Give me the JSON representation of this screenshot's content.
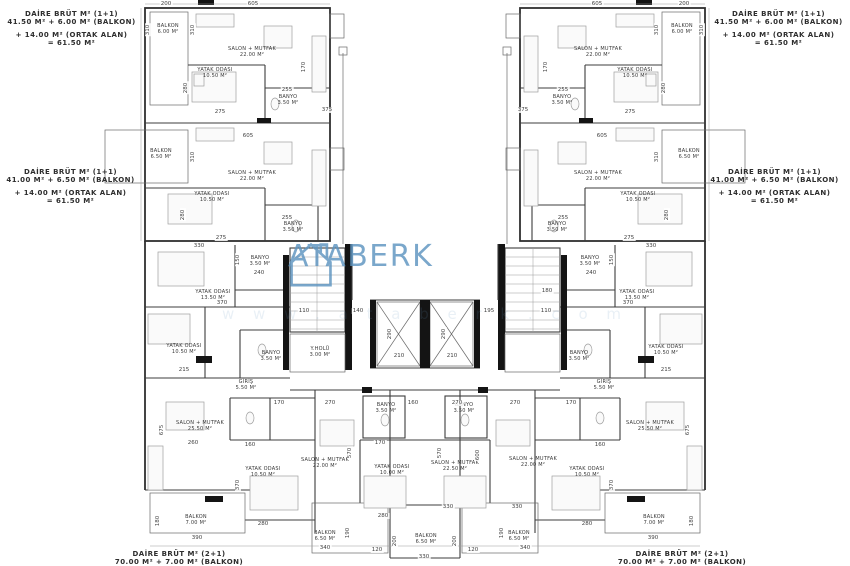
{
  "watermark": {
    "name": "ATABERK",
    "sub": "w w w . a t a b e r k . c o m",
    "color": "#5d94c0"
  },
  "annotations": {
    "top_left": [
      "DAİRE BRÜT M² (1+1)",
      "41.50 M² + 6.00 M² (BALKON)",
      "+ 14.00 M² (ORTAK ALAN)",
      "= 61.50 M²"
    ],
    "top_right": [
      "DAİRE BRÜT M² (1+1)",
      "41.50 M² + 6.00 M² (BALKON)",
      "+ 14.00 M² (ORTAK ALAN)",
      "= 61.50 M²"
    ],
    "mid_left": [
      "DAİRE BRÜT M² (1+1)",
      "41.00 M² + 6.50 M² (BALKON)",
      "+ 14.00 M² (ORTAK ALAN)",
      "= 61.50 M²"
    ],
    "mid_right": [
      "DAİRE BRÜT M² (1+1)",
      "41.00 M² + 6.50 M² (BALKON)",
      "+ 14.00 M² (ORTAK ALAN)",
      "= 61.50 M²"
    ],
    "bottom_left": [
      "DAİRE BRÜT M² (2+1)",
      "70.00 M² + 7.00 M² (BALKON)"
    ],
    "bottom_right": [
      "DAİRE BRÜT M² (2+1)",
      "70.00 M² + 7.00 M² (BALKON)"
    ]
  },
  "room_labels": [
    {
      "name": "BALKON",
      "area": "6.00 M²",
      "x": 168,
      "y": 30
    },
    {
      "name": "SALON + MUTFAK",
      "area": "22.00 M²",
      "x": 252,
      "y": 53
    },
    {
      "name": "YATAK ODASI",
      "area": "10.50 M²",
      "x": 215,
      "y": 74
    },
    {
      "name": "BANYO",
      "area": "3.50 M²",
      "x": 288,
      "y": 101
    },
    {
      "name": "BALKON",
      "area": "6.00 M²",
      "x": 682,
      "y": 30
    },
    {
      "name": "SALON + MUTFAK",
      "area": "22.00 M²",
      "x": 598,
      "y": 53
    },
    {
      "name": "YATAK ODASI",
      "area": "10.50 M²",
      "x": 635,
      "y": 74
    },
    {
      "name": "BANYO",
      "area": "3.50 M²",
      "x": 562,
      "y": 101
    },
    {
      "name": "BALKON",
      "area": "6.50 M²",
      "x": 161,
      "y": 155
    },
    {
      "name": "SALON + MUTFAK",
      "area": "22.00 M²",
      "x": 252,
      "y": 177
    },
    {
      "name": "YATAK ODASI",
      "area": "10.50 M²",
      "x": 212,
      "y": 198
    },
    {
      "name": "BANYO",
      "area": "3.50 M²",
      "x": 293,
      "y": 228
    },
    {
      "name": "BALKON",
      "area": "6.50 M²",
      "x": 689,
      "y": 155
    },
    {
      "name": "SALON + MUTFAK",
      "area": "22.00 M²",
      "x": 598,
      "y": 177
    },
    {
      "name": "YATAK ODASI",
      "area": "10.50 M²",
      "x": 638,
      "y": 198
    },
    {
      "name": "BANYO",
      "area": "3.50 M²",
      "x": 557,
      "y": 228
    },
    {
      "name": "YATAK ODASI",
      "area": "13.50 M²",
      "x": 213,
      "y": 296
    },
    {
      "name": "BANYO",
      "area": "3.50 M²",
      "x": 260,
      "y": 262
    },
    {
      "name": "YATAK ODASI",
      "area": "10.50 M²",
      "x": 184,
      "y": 350
    },
    {
      "name": "BANYO",
      "area": "3.50 M²",
      "x": 271,
      "y": 357
    },
    {
      "name": "Y.HOLÜ",
      "area": "3.00 M²",
      "x": 320,
      "y": 353
    },
    {
      "name": "GİRİŞ",
      "area": "5.50 M²",
      "x": 246,
      "y": 386
    },
    {
      "name": "YATAK ODASI",
      "area": "13.50 M²",
      "x": 637,
      "y": 296
    },
    {
      "name": "BANYO",
      "area": "3.50 M²",
      "x": 590,
      "y": 262
    },
    {
      "name": "YATAK ODASI",
      "area": "10.50 M²",
      "x": 666,
      "y": 351
    },
    {
      "name": "BANYO",
      "area": "3.50 M²",
      "x": 579,
      "y": 357
    },
    {
      "name": "GİRİŞ",
      "area": "5.50 M²",
      "x": 604,
      "y": 386
    },
    {
      "name": "SALON + MUTFAK",
      "area": "25.50 M²",
      "x": 200,
      "y": 427
    },
    {
      "name": "YATAK ODASI",
      "area": "10.50 M²",
      "x": 263,
      "y": 473
    },
    {
      "name": "BALKON",
      "area": "7.00 M²",
      "x": 196,
      "y": 521
    },
    {
      "name": "SALON + MUTFAK",
      "area": "25.50 M²",
      "x": 650,
      "y": 427
    },
    {
      "name": "YATAK ODASI",
      "area": "10.50 M²",
      "x": 587,
      "y": 473
    },
    {
      "name": "BALKON",
      "area": "7.00 M²",
      "x": 654,
      "y": 521
    },
    {
      "name": "SALON + MUTFAK",
      "area": "22.00 M²",
      "x": 325,
      "y": 464
    },
    {
      "name": "BANYO",
      "area": "3.50 M²",
      "x": 386,
      "y": 409
    },
    {
      "name": "YATAK ODASI",
      "area": "10.00 M²",
      "x": 392,
      "y": 471
    },
    {
      "name": "SALON + MUTFAK",
      "area": "22.50 M²",
      "x": 455,
      "y": 467
    },
    {
      "name": "BANYO",
      "area": "3.50 M²",
      "x": 464,
      "y": 409
    },
    {
      "name": "SALON + MUTFAK",
      "area": "22.00 M²",
      "x": 533,
      "y": 463
    },
    {
      "name": "BALKON",
      "area": "6.50 M²",
      "x": 325,
      "y": 537
    },
    {
      "name": "BALKON",
      "area": "6.50 M²",
      "x": 426,
      "y": 540
    },
    {
      "name": "BALKON",
      "area": "6.50 M²",
      "x": 519,
      "y": 537
    }
  ],
  "dim_labels": [
    {
      "text": "200",
      "x": 166,
      "y": 4
    },
    {
      "text": "605",
      "x": 253,
      "y": 4
    },
    {
      "text": "605",
      "x": 597,
      "y": 4
    },
    {
      "text": "200",
      "x": 684,
      "y": 4
    },
    {
      "text": "310",
      "x": 148,
      "y": 30,
      "rot": true
    },
    {
      "text": "310",
      "x": 193,
      "y": 30,
      "rot": true
    },
    {
      "text": "280",
      "x": 186,
      "y": 88,
      "rot": true
    },
    {
      "text": "170",
      "x": 304,
      "y": 67,
      "rot": true
    },
    {
      "text": "255",
      "x": 287,
      "y": 90
    },
    {
      "text": "275",
      "x": 220,
      "y": 112
    },
    {
      "text": "375",
      "x": 327,
      "y": 110
    },
    {
      "text": "310",
      "x": 657,
      "y": 30,
      "rot": true
    },
    {
      "text": "310",
      "x": 702,
      "y": 30,
      "rot": true
    },
    {
      "text": "280",
      "x": 664,
      "y": 88,
      "rot": true
    },
    {
      "text": "170",
      "x": 546,
      "y": 67,
      "rot": true
    },
    {
      "text": "255",
      "x": 563,
      "y": 90
    },
    {
      "text": "275",
      "x": 630,
      "y": 112
    },
    {
      "text": "375",
      "x": 523,
      "y": 110
    },
    {
      "text": "605",
      "x": 248,
      "y": 136
    },
    {
      "text": "605",
      "x": 602,
      "y": 136
    },
    {
      "text": "310",
      "x": 193,
      "y": 157,
      "rot": true
    },
    {
      "text": "310",
      "x": 657,
      "y": 157,
      "rot": true
    },
    {
      "text": "280",
      "x": 183,
      "y": 215,
      "rot": true
    },
    {
      "text": "280",
      "x": 667,
      "y": 215,
      "rot": true
    },
    {
      "text": "255",
      "x": 287,
      "y": 218
    },
    {
      "text": "255",
      "x": 563,
      "y": 218
    },
    {
      "text": "275",
      "x": 221,
      "y": 238
    },
    {
      "text": "275",
      "x": 629,
      "y": 238
    },
    {
      "text": "330",
      "x": 199,
      "y": 246
    },
    {
      "text": "330",
      "x": 651,
      "y": 246
    },
    {
      "text": "150",
      "x": 238,
      "y": 260,
      "rot": true
    },
    {
      "text": "150",
      "x": 612,
      "y": 260,
      "rot": true
    },
    {
      "text": "240",
      "x": 259,
      "y": 273
    },
    {
      "text": "240",
      "x": 591,
      "y": 273
    },
    {
      "text": "370",
      "x": 222,
      "y": 303
    },
    {
      "text": "370",
      "x": 628,
      "y": 303
    },
    {
      "text": "110",
      "x": 304,
      "y": 311
    },
    {
      "text": "110",
      "x": 546,
      "y": 311
    },
    {
      "text": "140",
      "x": 358,
      "y": 311
    },
    {
      "text": "195",
      "x": 489,
      "y": 311
    },
    {
      "text": "290",
      "x": 390,
      "y": 334,
      "rot": true
    },
    {
      "text": "290",
      "x": 444,
      "y": 334,
      "rot": true
    },
    {
      "text": "210",
      "x": 399,
      "y": 356
    },
    {
      "text": "210",
      "x": 452,
      "y": 356
    },
    {
      "text": "180",
      "x": 547,
      "y": 291
    },
    {
      "text": "215",
      "x": 184,
      "y": 370
    },
    {
      "text": "215",
      "x": 666,
      "y": 370
    },
    {
      "text": "675",
      "x": 162,
      "y": 430,
      "rot": true
    },
    {
      "text": "675",
      "x": 688,
      "y": 430,
      "rot": true
    },
    {
      "text": "170",
      "x": 279,
      "y": 403
    },
    {
      "text": "170",
      "x": 571,
      "y": 403
    },
    {
      "text": "270",
      "x": 330,
      "y": 403
    },
    {
      "text": "160",
      "x": 413,
      "y": 403
    },
    {
      "text": "270",
      "x": 457,
      "y": 403
    },
    {
      "text": "270",
      "x": 515,
      "y": 403
    },
    {
      "text": "170",
      "x": 380,
      "y": 443
    },
    {
      "text": "160",
      "x": 250,
      "y": 445
    },
    {
      "text": "160",
      "x": 600,
      "y": 445
    },
    {
      "text": "260",
      "x": 193,
      "y": 443
    },
    {
      "text": "570",
      "x": 350,
      "y": 453,
      "rot": true
    },
    {
      "text": "570",
      "x": 440,
      "y": 453,
      "rot": true
    },
    {
      "text": "600",
      "x": 478,
      "y": 455,
      "rot": true
    },
    {
      "text": "370",
      "x": 238,
      "y": 485,
      "rot": true
    },
    {
      "text": "370",
      "x": 612,
      "y": 485,
      "rot": true
    },
    {
      "text": "330",
      "x": 448,
      "y": 507
    },
    {
      "text": "330",
      "x": 517,
      "y": 507
    },
    {
      "text": "280",
      "x": 383,
      "y": 516
    },
    {
      "text": "280",
      "x": 263,
      "y": 524
    },
    {
      "text": "280",
      "x": 587,
      "y": 524
    },
    {
      "text": "180",
      "x": 158,
      "y": 521,
      "rot": true
    },
    {
      "text": "180",
      "x": 692,
      "y": 521,
      "rot": true
    },
    {
      "text": "390",
      "x": 197,
      "y": 538
    },
    {
      "text": "390",
      "x": 653,
      "y": 538
    },
    {
      "text": "190",
      "x": 348,
      "y": 533,
      "rot": true
    },
    {
      "text": "190",
      "x": 502,
      "y": 533,
      "rot": true
    },
    {
      "text": "200",
      "x": 395,
      "y": 541,
      "rot": true
    },
    {
      "text": "200",
      "x": 455,
      "y": 541,
      "rot": true
    },
    {
      "text": "340",
      "x": 325,
      "y": 548
    },
    {
      "text": "340",
      "x": 525,
      "y": 548
    },
    {
      "text": "120",
      "x": 377,
      "y": 550
    },
    {
      "text": "120",
      "x": 473,
      "y": 550
    },
    {
      "text": "330",
      "x": 424,
      "y": 557
    }
  ]
}
